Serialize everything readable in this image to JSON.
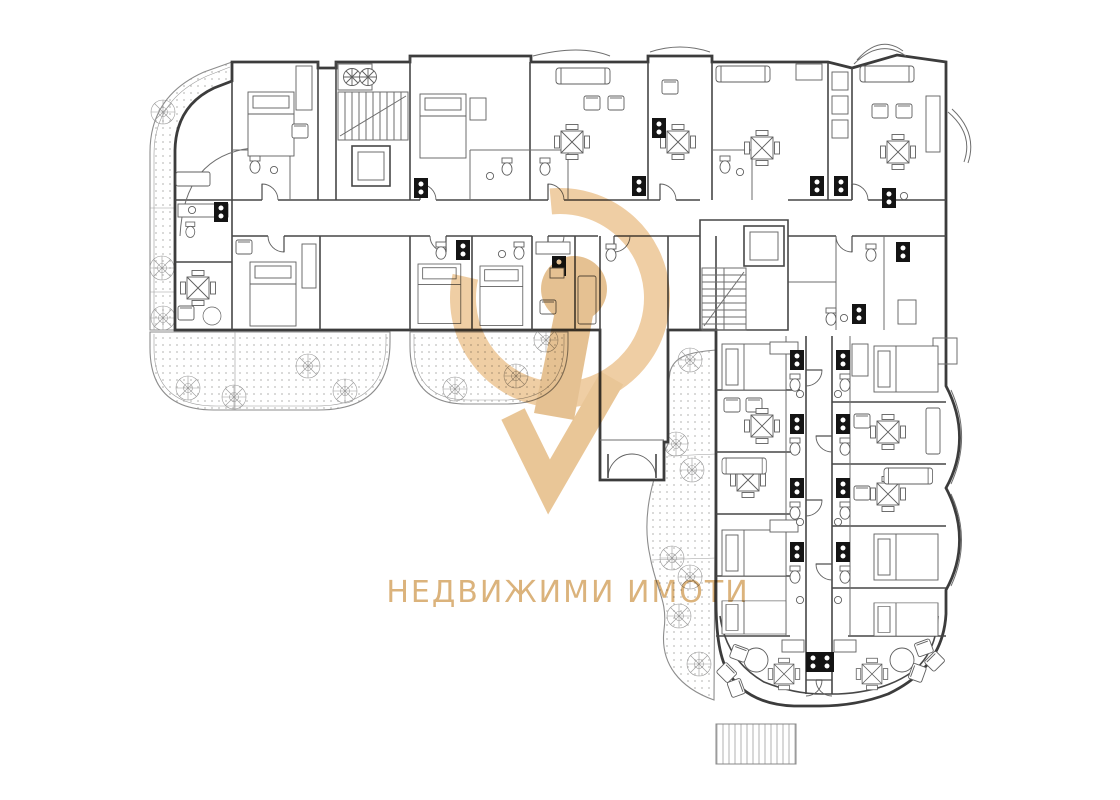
{
  "page": {
    "background": "#ffffff",
    "content_type": "architectural-floor-plan"
  },
  "palette": {
    "wall_line": "#3c3c3c",
    "partition_line": "#6e6e6e",
    "furniture_line": "#5f5f5f",
    "garden_border": "#8d8d8d",
    "hatch_dot": "#c0bfbd",
    "tree_line": "#9b9b9b",
    "appliance_fill": "#141414",
    "watermark_ring": "#ecc390",
    "watermark_keyhole": "#e0b47a",
    "watermark_text": "#d9ad72"
  },
  "watermark": {
    "brand_text": "НЕДВИЖИМИ ИМОТИ",
    "logo_parts": [
      "ring",
      "keyhole",
      "check-tail"
    ]
  },
  "plan_features": {
    "wings": [
      "north-wing",
      "east-wing"
    ],
    "stair_cores": [
      "west-stair-core",
      "central-stair-core"
    ],
    "entrance": "south-vestibule",
    "gardens": [
      "west-border-garden",
      "southwest-garden",
      "south-garden",
      "east-wing-garden"
    ],
    "deck": "south-deck",
    "tree_count": 17,
    "legend_icons": [
      "tree-icon",
      "dining-table-icon",
      "round-table-icon",
      "bed-icon",
      "sofa-icon",
      "armchair-icon",
      "stove-icon",
      "toilet-icon",
      "sink-icon",
      "fan-icon",
      "door-icon",
      "elevator-icon",
      "stairs-icon"
    ]
  }
}
